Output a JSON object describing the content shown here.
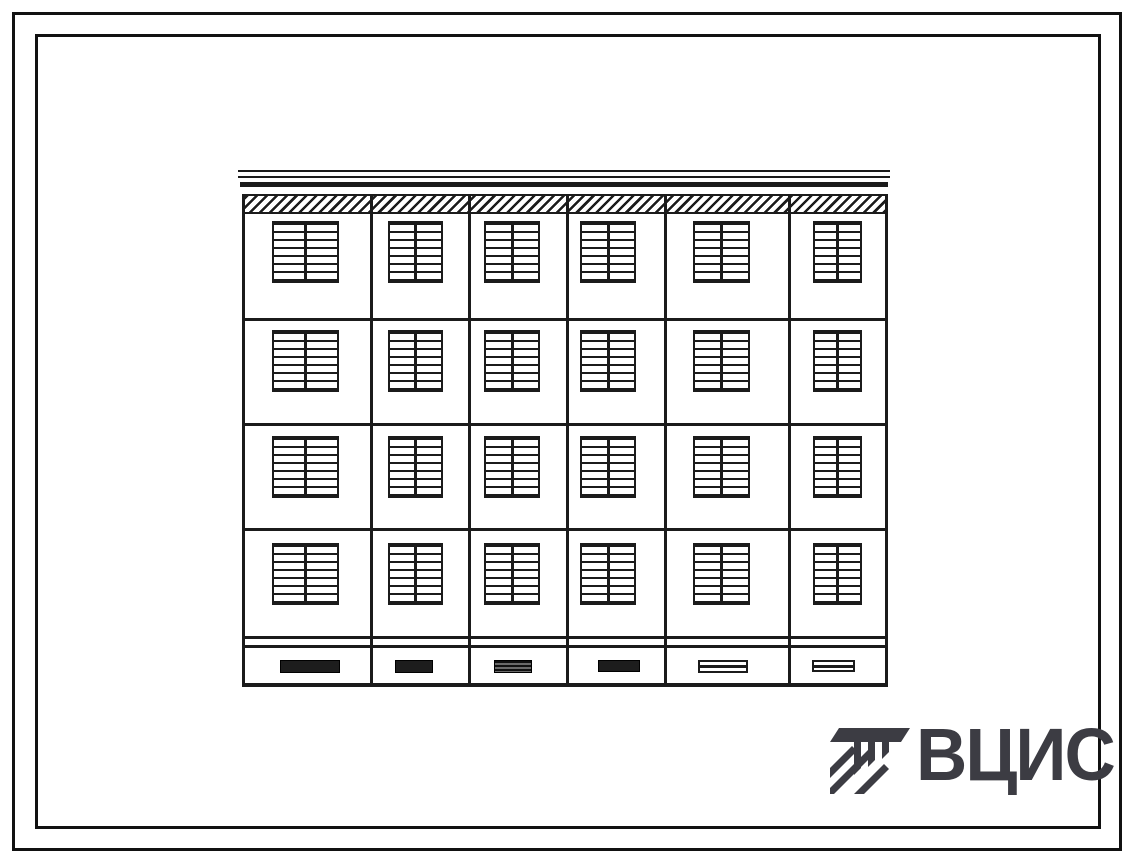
{
  "colors": {
    "paper": "#ffffff",
    "line": "#1b1b1b",
    "logo": "#3c3c43"
  },
  "logo": {
    "text": "ВЦИС",
    "icon": "hatched-tee-construction-emblem"
  },
  "facade": {
    "type": "panel-building-front-elevation",
    "floors": 4,
    "window_columns_count": 6,
    "window_rows_count": 4,
    "basement_windows_count": 6,
    "geometry": {
      "left": 242,
      "top": 170,
      "right": 888,
      "bottom": 686
    },
    "parapet_lines": [
      {
        "x": 238,
        "w": 652,
        "y": 170,
        "h": 2
      },
      {
        "x": 238,
        "w": 652,
        "y": 176,
        "h": 2
      },
      {
        "x": 240,
        "w": 648,
        "y": 182,
        "h": 5
      }
    ],
    "hatch_band": {
      "y": 194,
      "h": 16
    },
    "floor_lines": [
      {
        "y": 318,
        "h": 3
      },
      {
        "y": 423,
        "h": 3
      },
      {
        "y": 528,
        "h": 3
      },
      {
        "y": 636,
        "h": 3
      },
      {
        "y": 645,
        "h": 3
      },
      {
        "y": 683,
        "h": 4
      }
    ],
    "seams": [
      370,
      468,
      566,
      664,
      788
    ],
    "window_rows": [
      221,
      330,
      436,
      543
    ],
    "window_height": 62,
    "window_columns": [
      {
        "x": 272,
        "w": 67
      },
      {
        "x": 388,
        "w": 55
      },
      {
        "x": 484,
        "w": 56
      },
      {
        "x": 580,
        "w": 56
      },
      {
        "x": 693,
        "w": 57
      },
      {
        "x": 813,
        "w": 49
      }
    ],
    "basement_windows": [
      {
        "x": 280,
        "w": 60,
        "h": 13,
        "style": "dark"
      },
      {
        "x": 395,
        "w": 38,
        "h": 13,
        "style": "dark"
      },
      {
        "x": 494,
        "w": 38,
        "h": 13,
        "style": "dark-striped"
      },
      {
        "x": 598,
        "w": 42,
        "h": 12,
        "style": "dark"
      },
      {
        "x": 698,
        "w": 50,
        "h": 13,
        "style": "light-striped"
      },
      {
        "x": 812,
        "w": 43,
        "h": 12,
        "style": "light-striped"
      }
    ],
    "basement_window_y": 660
  }
}
